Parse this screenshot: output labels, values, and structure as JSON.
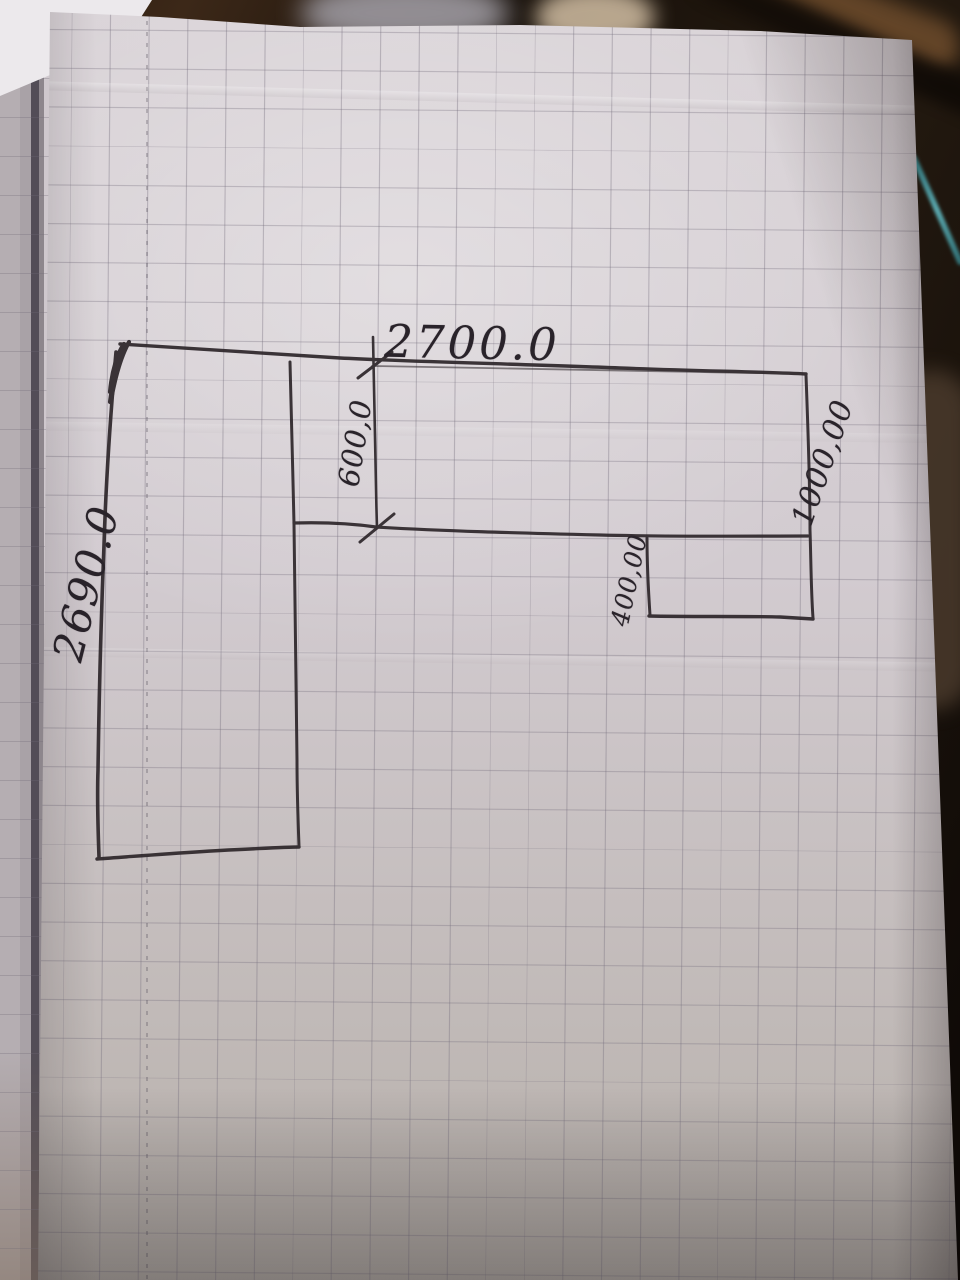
{
  "sketch": {
    "dimensions": {
      "top_width": "2700.0",
      "left_height": "2690.0",
      "top_band_depth": "600,0",
      "right_height": "1000,00",
      "notch_depth": "400,00"
    },
    "colors": {
      "ink": "#2d262a",
      "paper": "#d2cbd0",
      "grid_line": "#766f7c",
      "background_table": "#1c130c",
      "table_edge_teal": "#4e9aa0"
    }
  }
}
